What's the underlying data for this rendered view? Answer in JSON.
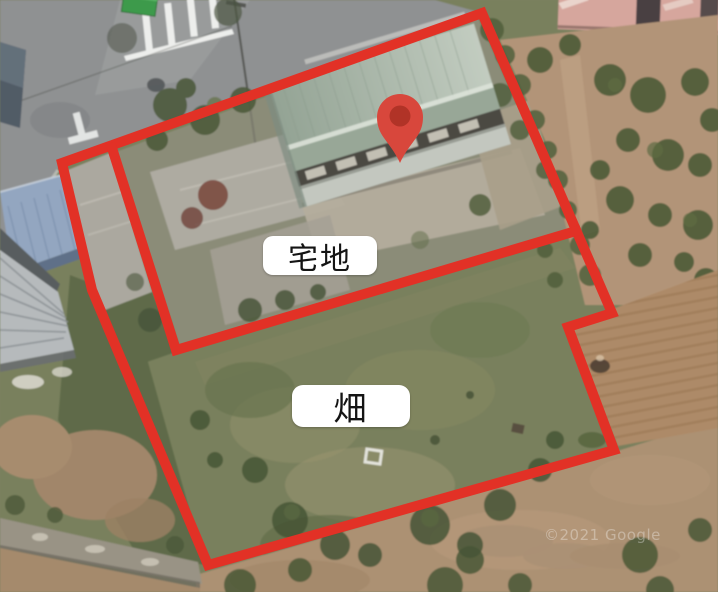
{
  "map": {
    "kind": "satellite-aerial-annotation",
    "parcel_labels": [
      {
        "id": "takuchi",
        "text": "宅地"
      },
      {
        "id": "hatake",
        "text": "畑"
      }
    ],
    "watermark": "©2021 Google",
    "colors": {
      "boundary_red": "#e23126",
      "pin_red": "#d8473c",
      "pin_inner_red": "#b13327",
      "label_bg": "#ffffff",
      "label_text": "#141414"
    }
  }
}
